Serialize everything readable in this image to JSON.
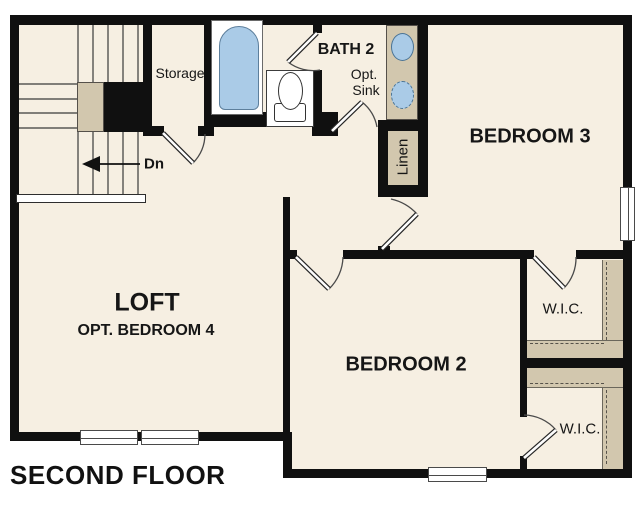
{
  "floor_plan": {
    "title": "SECOND FLOOR",
    "labels": {
      "loft": "LOFT",
      "loft_option": "OPT. BEDROOM 4",
      "bedroom2": "BEDROOM 2",
      "bedroom3": "BEDROOM 3",
      "bath2": "BATH 2",
      "storage": "Storage",
      "opt_sink_line1": "Opt.",
      "opt_sink_line2": "Sink",
      "linen": "Linen",
      "wic_top": "W.I.C.",
      "wic_bottom": "W.I.C.",
      "stairs_down": "Dn"
    },
    "colors": {
      "wall": "#101010",
      "floor": "#f6efe2",
      "casework_tan": "#d2c7ae",
      "fixture_blue": "#aacbe7",
      "background": "#ffffff"
    }
  }
}
